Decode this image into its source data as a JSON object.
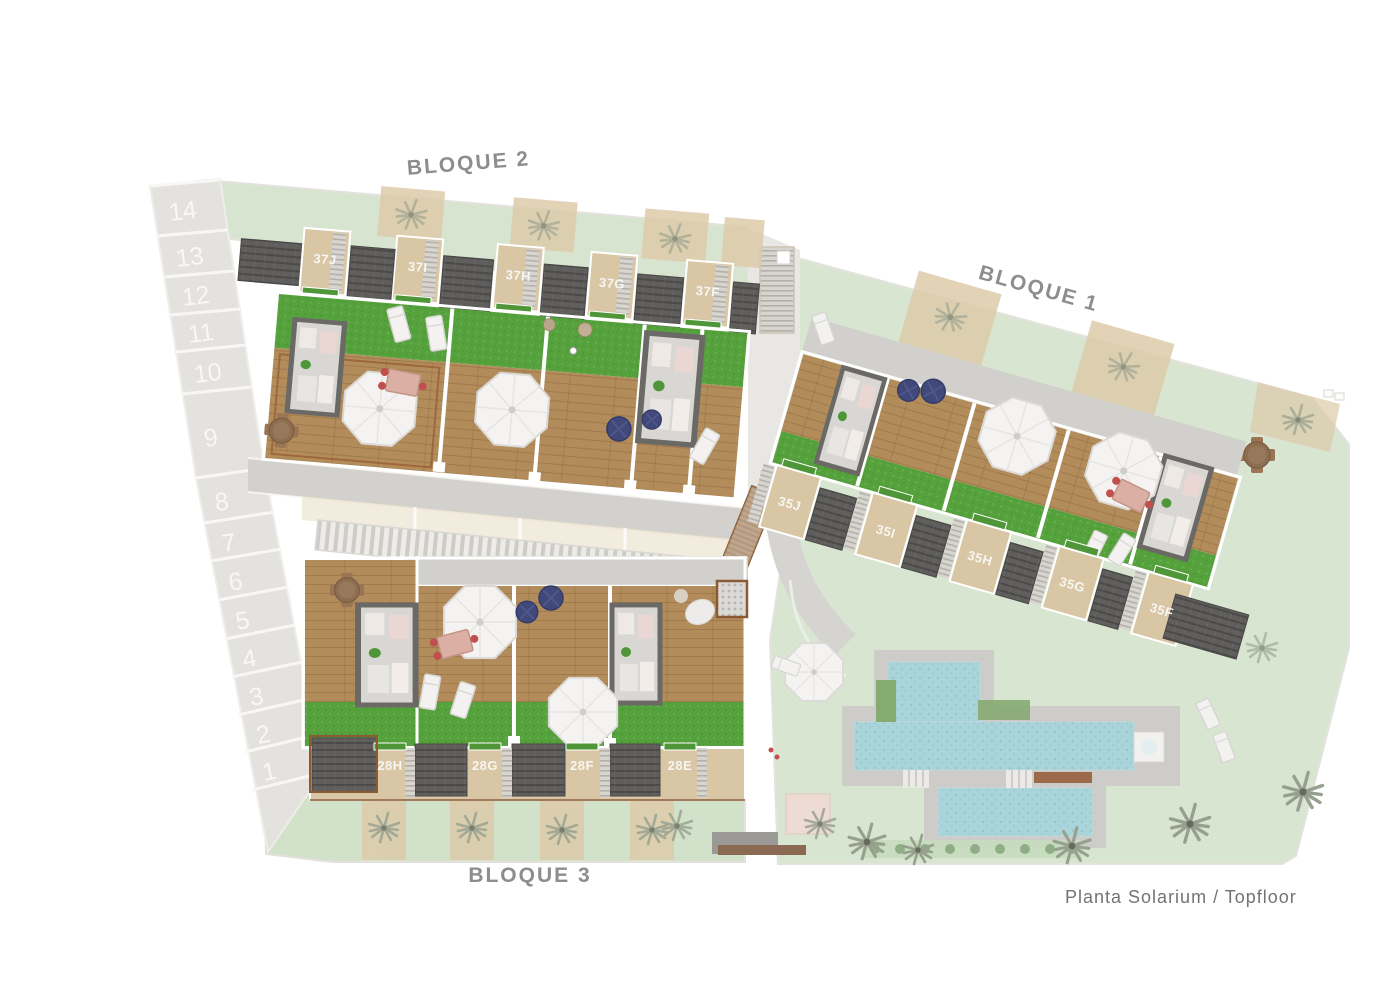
{
  "plan": {
    "caption": "Planta Solarium / Topfloor",
    "blocks": {
      "bloque2": {
        "label": "BLOQUE 2",
        "units": [
          "37J",
          "37I",
          "37H",
          "37G",
          "37F"
        ]
      },
      "bloque1": {
        "label": "BLOQUE 1",
        "units": [
          "35J",
          "35I",
          "35H",
          "35G",
          "35F"
        ]
      },
      "bloque3": {
        "label": "BLOQUE 3",
        "units": [
          "28H",
          "28G",
          "28F",
          "28E"
        ]
      }
    },
    "parking": {
      "spaces": [
        "14",
        "13",
        "12",
        "11",
        "10",
        "9",
        "8",
        "7",
        "6",
        "5",
        "4",
        "3",
        "2",
        "1"
      ]
    },
    "colors": {
      "lawn_light": "#d7e4cf",
      "turf_green": "#55a13c",
      "wood_deck": "#b38c5c",
      "solar_panel": "#5f5e5c",
      "pool_water": "#a9d4da",
      "walkway_gray": "#d2d0cc",
      "unit_tan": "#d9c6a4",
      "edge_brown": "#8a5a33",
      "label_gray": "#8d8d8d"
    },
    "icons": {
      "palm": "palm-tree-icon",
      "parasol": "parasol-icon",
      "lounger": "sun-lounger-icon",
      "dining": "dining-set-icon",
      "pouf": "pouf-icon"
    }
  }
}
